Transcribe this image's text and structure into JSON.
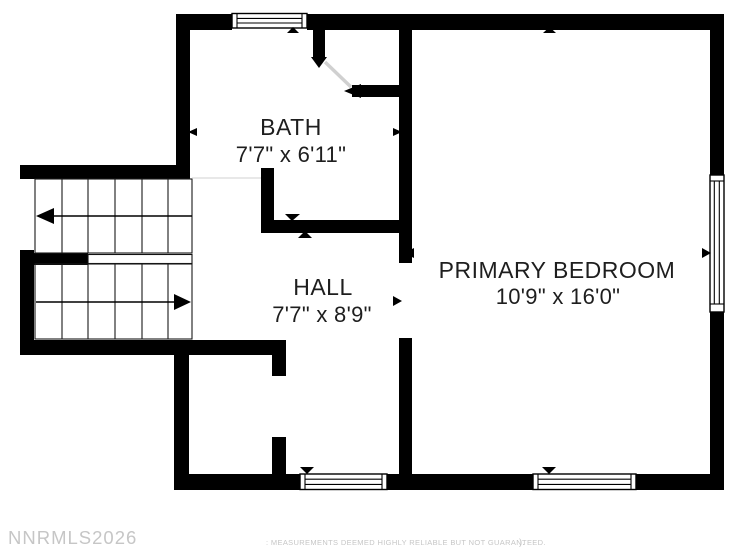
{
  "plan": {
    "rooms": [
      {
        "id": "bath",
        "label": "BATH",
        "dimensions": "7'7\" x 6'11\""
      },
      {
        "id": "hall",
        "label": "HALL",
        "dimensions": "7'7\" x 8'9\""
      },
      {
        "id": "primary-bedroom",
        "label": "PRIMARY BEDROOM",
        "dimensions": "10'9\" x 16'0\""
      }
    ],
    "features": {
      "window_count": 4,
      "doors": [
        "bath-door",
        "bedroom-door",
        "closet-door"
      ],
      "stairs": "u-shaped-switchback"
    }
  },
  "watermarks": {
    "mls_id": "NNRMLS2026",
    "disclaimer": ": MEASUREMENTS DEEMED HIGHLY RELIABLE BUT NOT GUARANTEED.",
    "stray_mark": ")."
  },
  "colors": {
    "wall": "#000000",
    "label_text": "#1e1e1e",
    "watermark": "#c6c6c6",
    "door_leaf": "#d0d0d0"
  }
}
